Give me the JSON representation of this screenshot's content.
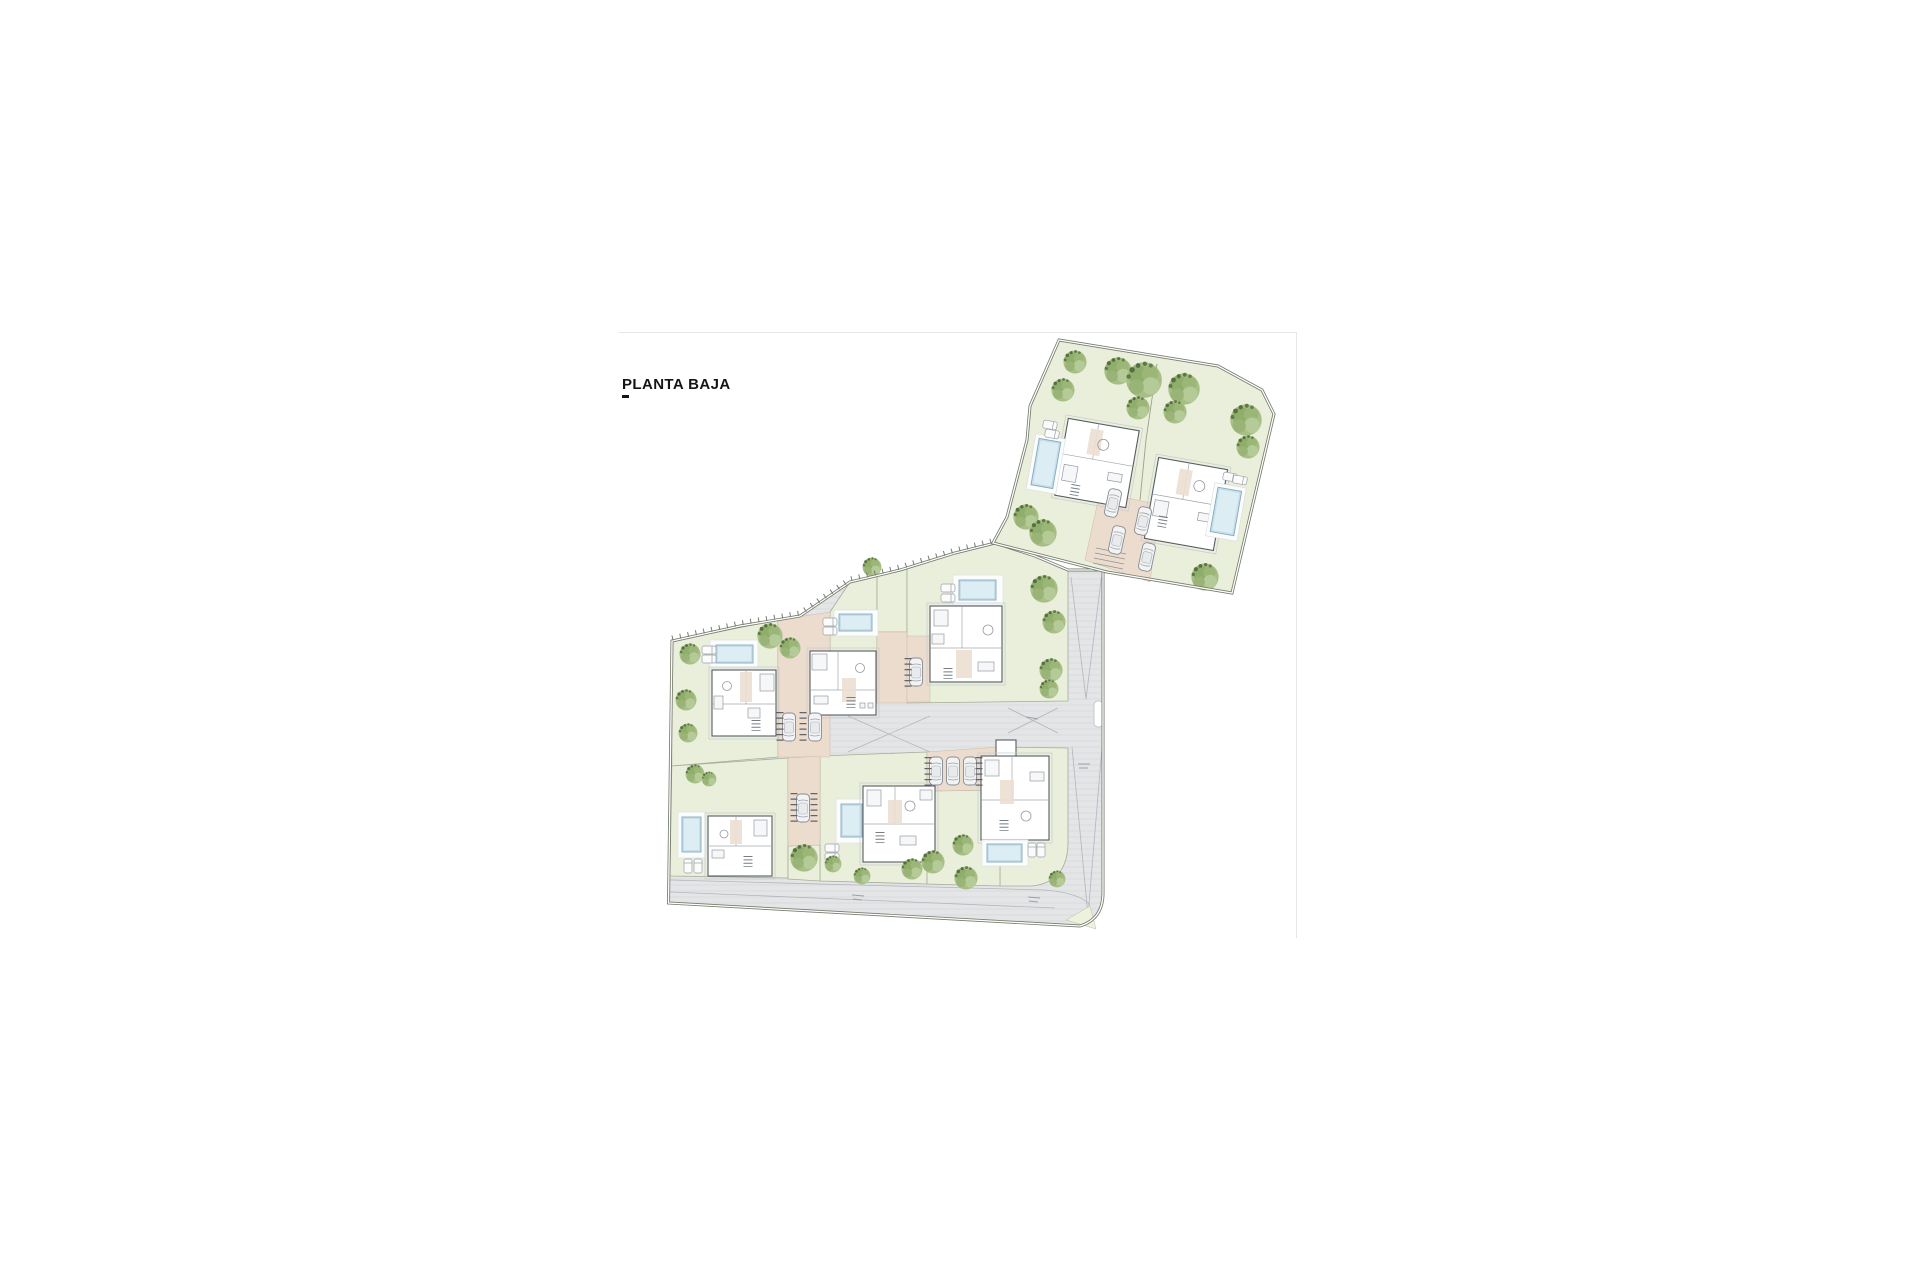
{
  "page": {
    "title": "PLANTA BAJA",
    "background": "#ffffff"
  },
  "plan": {
    "type": "architectural-site-plan",
    "floor_shown": "ground floor",
    "clusters": [
      {
        "name": "main-cluster",
        "plots": 6,
        "rows": 2,
        "villas": 6
      },
      {
        "name": "upper-right-parcel",
        "plots": 2,
        "villas": 2
      }
    ],
    "totals": {
      "villas": 8,
      "pools": 8,
      "trees": 32,
      "cars": 12,
      "lounger_pairs": 8
    },
    "roads": [
      "access-road-right",
      "bottom-perimeter-road",
      "central-driveway"
    ],
    "road_markings": {
      "slope_triangles": 2,
      "cross_visibility_marks": 2
    },
    "colors": {
      "plot_green": "#e9efda",
      "road_gray": "#e4e5e7",
      "pool_blue": "#c6dfea",
      "terrace_beige": "#ecdccd",
      "tree_green": "#9bb677",
      "boundary": "#767c6e",
      "building_wall": "#565c63"
    }
  }
}
